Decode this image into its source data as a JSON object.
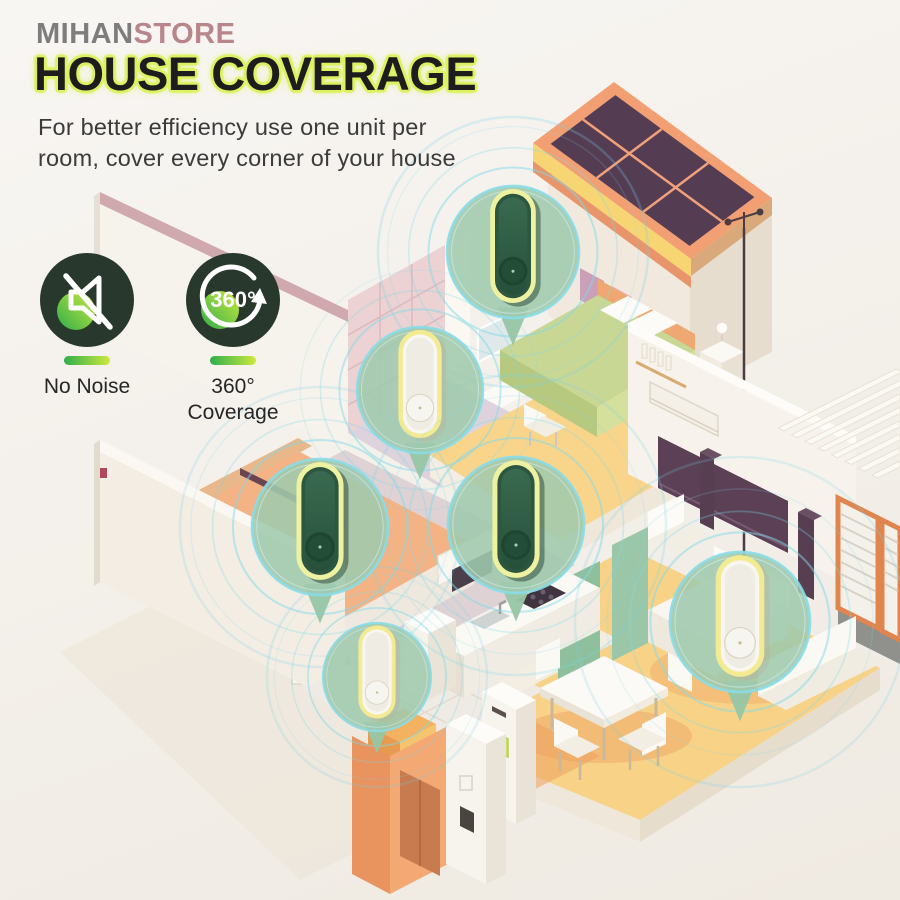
{
  "header": {
    "brand": {
      "mihan": "MIHAN",
      "store": "STORE"
    },
    "title": "HOUSE COVERAGE",
    "subtitle_line1": "For better efficiency use one unit per",
    "subtitle_line2": "room, cover every corner of your house"
  },
  "features": [
    {
      "icon": "muted-speaker-icon",
      "label_line1": "No Noise",
      "label_line2": ""
    },
    {
      "icon": "rotation-360-icon",
      "icon_text": "360°",
      "label_line1": "360°",
      "label_line2": "Coverage"
    }
  ],
  "illustration": {
    "type": "isometric cutaway house with solar roof",
    "device_count": 6,
    "devices": [
      {
        "location": "upper bedroom",
        "variant": "green"
      },
      {
        "location": "upper bathroom",
        "variant": "white"
      },
      {
        "location": "lower bedroom",
        "variant": "green"
      },
      {
        "location": "hallway center",
        "variant": "green"
      },
      {
        "location": "laundry room",
        "variant": "white"
      },
      {
        "location": "living room",
        "variant": "white"
      }
    ]
  },
  "colors": {
    "background": "#f3efe9",
    "brand_gray": "#7d7d7d",
    "brand_rose": "#b8858a",
    "title_text": "#1d1d1d",
    "title_glow": "#ddf163",
    "badge_background": "#29382c",
    "accent_green": "#2fae4a",
    "accent_lime": "#cde93f",
    "device_green": "#2e5a40",
    "device_ring_yellow": "#eef1a0",
    "callout_fill": "#9fc9ad",
    "ripple_cyan": "#7fd9e9",
    "roof_salmon": "#f29f74",
    "solar_panel": "#543d53",
    "floor_yellow": "#f8d287"
  }
}
